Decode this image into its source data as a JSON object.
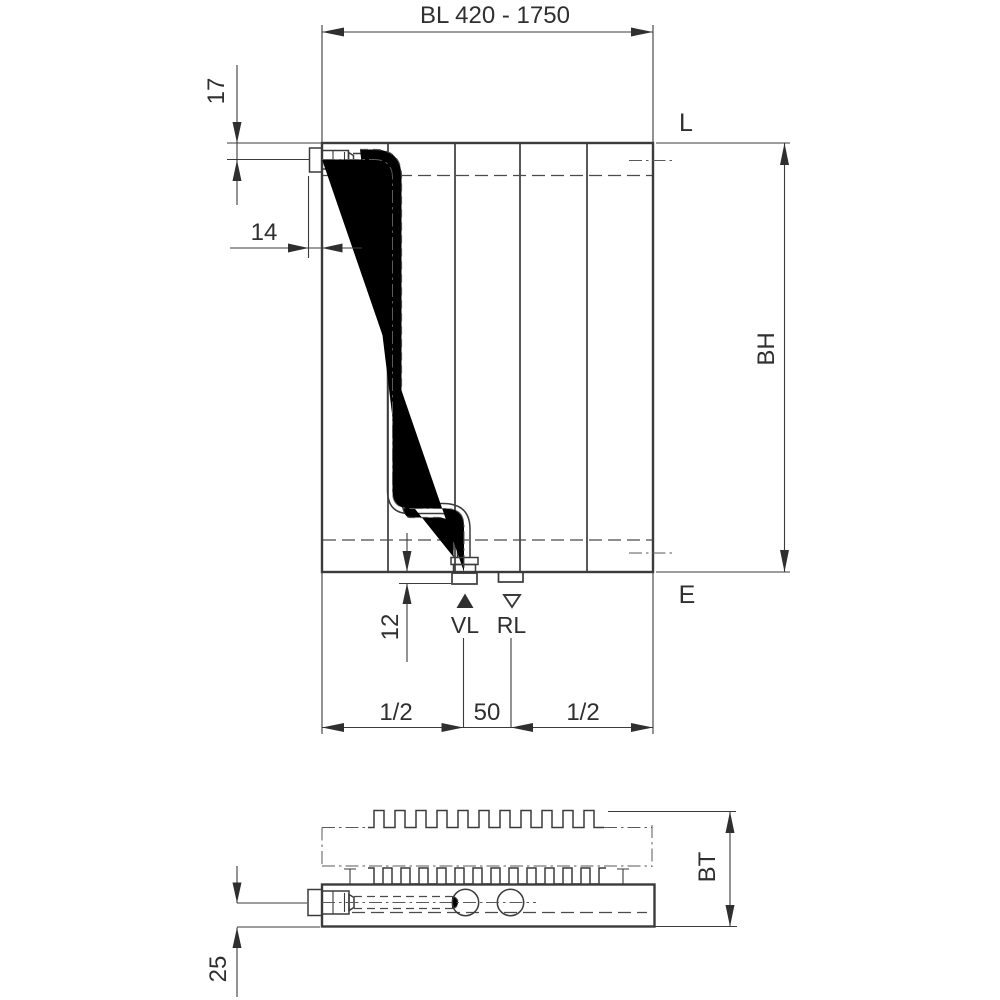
{
  "drawing": {
    "type": "radiator-technical-dimension-drawing",
    "front_view": {
      "width_range_label": "BL 420 - 1750",
      "height_label": "BH",
      "top_pipe_offset": "17",
      "left_connection_offset": "14",
      "bottom_protrusion": "12",
      "left_half_span": "1/2",
      "connection_spacing": "50",
      "right_half_span": "1/2",
      "supply_label": "VL",
      "return_label": "RL",
      "top_right_marker": "L",
      "bottom_right_marker": "E"
    },
    "bottom_view": {
      "depth_label": "BT",
      "pipe_axis_offset": "25"
    },
    "symbols": {
      "supply_marker": "filled-triangle-up-icon",
      "return_marker": "outlined-triangle-down-icon"
    },
    "colors": {
      "line": "#3b3b3b",
      "text": "#2f2f2f",
      "background": "#ffffff"
    }
  }
}
